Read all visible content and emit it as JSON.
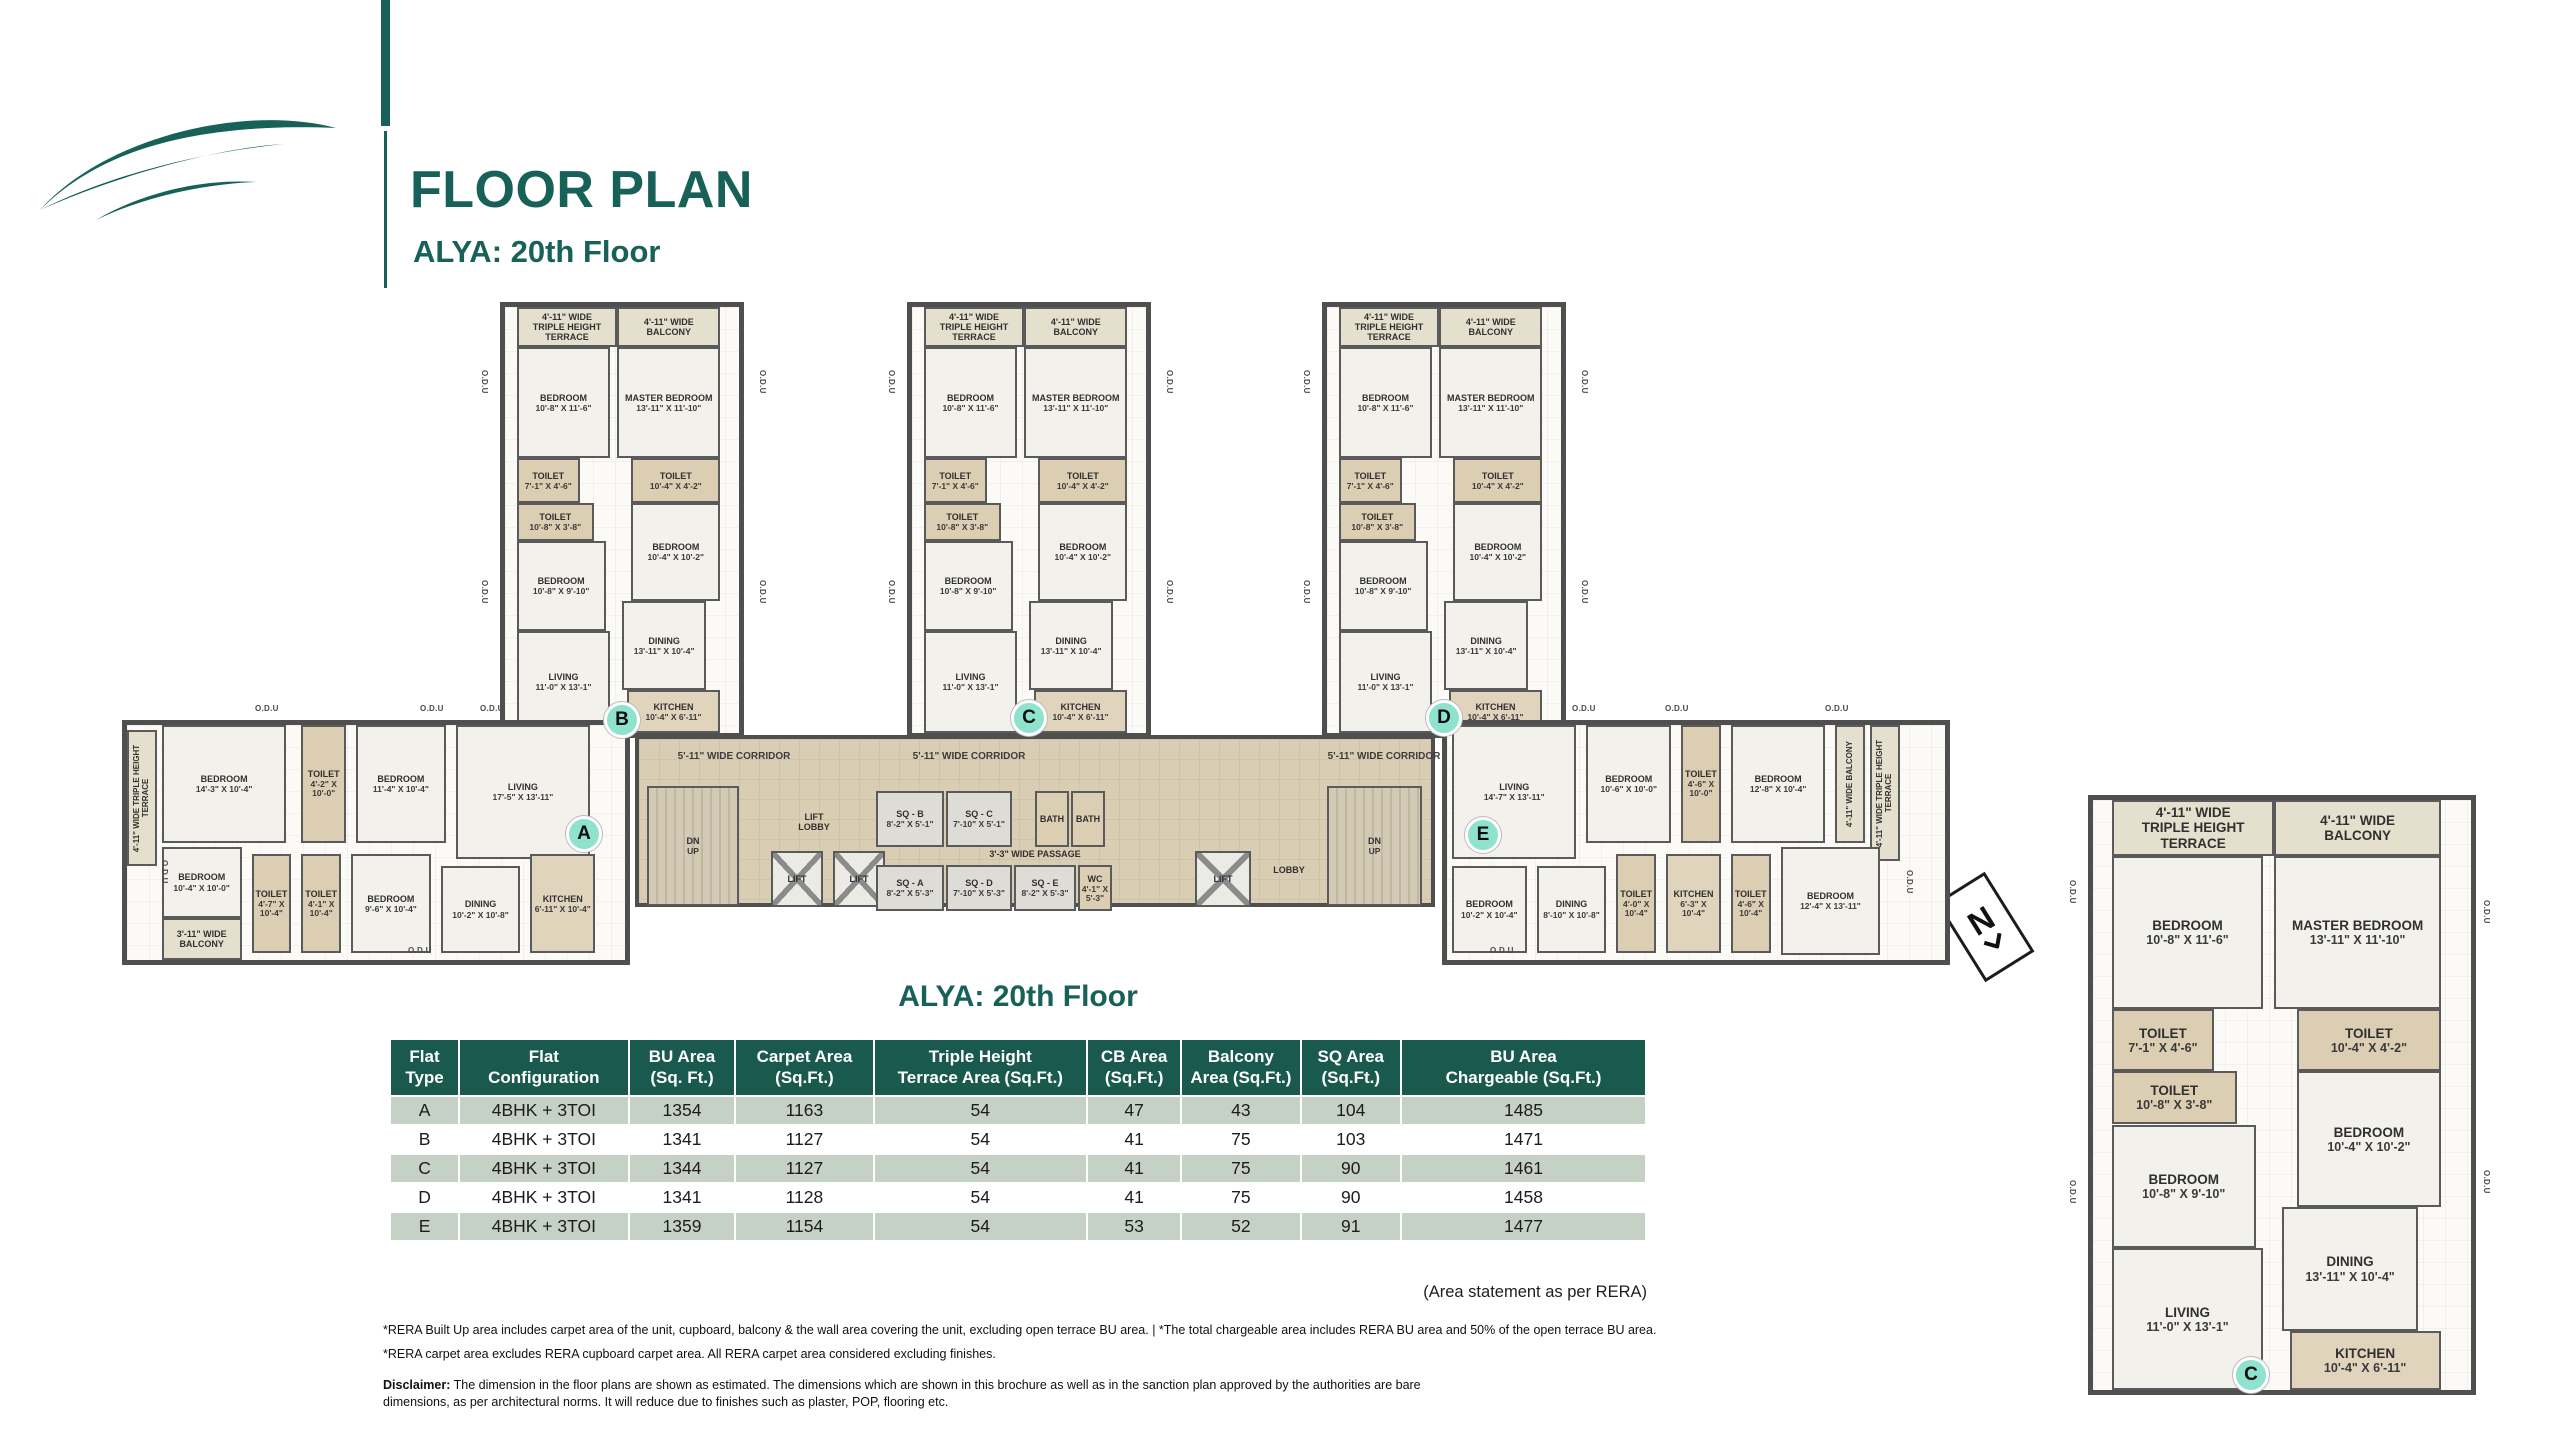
{
  "header": {
    "title": "FLOOR PLAN",
    "subtitle": "ALYA: 20th Floor"
  },
  "colors": {
    "brand_teal": "#176158",
    "table_header_green": "#1a5a4e",
    "row_sage": "#c6d1c6",
    "corridor_tan": "#d9cdb3",
    "wall_gray": "#4f4f4f",
    "marker_mint": "#8fe2cd"
  },
  "compass": {
    "letter": "N"
  },
  "plan": {
    "odu": {
      "label": "O.D.U",
      "positions": [
        {
          "x": 480,
          "y": 370,
          "v": true
        },
        {
          "x": 480,
          "y": 580,
          "v": true
        },
        {
          "x": 758,
          "y": 370,
          "v": true
        },
        {
          "x": 758,
          "y": 580,
          "v": true
        },
        {
          "x": 887,
          "y": 370,
          "v": true
        },
        {
          "x": 887,
          "y": 580,
          "v": true
        },
        {
          "x": 1165,
          "y": 370,
          "v": true
        },
        {
          "x": 1165,
          "y": 580,
          "v": true
        },
        {
          "x": 1302,
          "y": 370,
          "v": true
        },
        {
          "x": 1302,
          "y": 580,
          "v": true
        },
        {
          "x": 1580,
          "y": 370,
          "v": true
        },
        {
          "x": 1580,
          "y": 580,
          "v": true
        },
        {
          "x": 255,
          "y": 704
        },
        {
          "x": 420,
          "y": 704
        },
        {
          "x": 480,
          "y": 704
        },
        {
          "x": 408,
          "y": 946
        },
        {
          "x": 1572,
          "y": 704
        },
        {
          "x": 1665,
          "y": 704
        },
        {
          "x": 1825,
          "y": 704
        },
        {
          "x": 1490,
          "y": 946
        },
        {
          "x": 160,
          "y": 860,
          "v": true
        },
        {
          "x": 1905,
          "y": 870,
          "v": true
        },
        {
          "x": 2068,
          "y": 880,
          "v": true
        },
        {
          "x": 2068,
          "y": 1180,
          "v": true
        },
        {
          "x": 2482,
          "y": 900,
          "v": true
        },
        {
          "x": 2482,
          "y": 1170,
          "v": true
        }
      ]
    },
    "markers": [
      {
        "letter": "A",
        "cx": 584,
        "cy": 834
      },
      {
        "letter": "B",
        "cx": 622,
        "cy": 720
      },
      {
        "letter": "C",
        "cx": 1029,
        "cy": 718
      },
      {
        "letter": "D",
        "cx": 1444,
        "cy": 718
      },
      {
        "letter": "E",
        "cx": 1483,
        "cy": 835
      },
      {
        "letter": "C",
        "cx": 2251,
        "cy": 1375
      }
    ],
    "sections": [
      {
        "id": "tower-b",
        "x": 500,
        "y": 302,
        "w": 244,
        "h": 436,
        "rooms": "tower"
      },
      {
        "id": "tower-c",
        "x": 907,
        "y": 302,
        "w": 244,
        "h": 436,
        "rooms": "tower"
      },
      {
        "id": "tower-d",
        "x": 1322,
        "y": 302,
        "w": 244,
        "h": 436,
        "rooms": "tower"
      },
      {
        "id": "wing-a",
        "x": 122,
        "y": 720,
        "w": 508,
        "h": 245,
        "rooms": "wing_a"
      },
      {
        "id": "wing-e",
        "x": 1442,
        "y": 720,
        "w": 508,
        "h": 245,
        "rooms": "wing_e"
      },
      {
        "id": "detail-c",
        "x": 2088,
        "y": 795,
        "w": 388,
        "h": 600,
        "rooms": "tower",
        "detail": true
      }
    ],
    "room_templates": {
      "tower": [
        {
          "t": "terrace",
          "label": "4'-11\" WIDE\nTRIPLE HEIGHT\nTERRACE",
          "x": 5,
          "y": 0,
          "w": 43,
          "h": 9.5
        },
        {
          "t": "balcony",
          "label": "4'-11\" WIDE\nBALCONY",
          "x": 48,
          "y": 0,
          "w": 44,
          "h": 9.5
        },
        {
          "t": "room",
          "label": "BEDROOM",
          "dims": "10'-8\" X 11'-6\"",
          "x": 5,
          "y": 9.5,
          "w": 40,
          "h": 26
        },
        {
          "t": "room",
          "label": "MASTER BEDROOM",
          "dims": "13'-11\" X 11'-10\"",
          "x": 48,
          "y": 9.5,
          "w": 44,
          "h": 26
        },
        {
          "t": "toilet",
          "label": "TOILET",
          "dims": "7'-1\" X 4'-6\"",
          "x": 5,
          "y": 35.5,
          "w": 27,
          "h": 10.5
        },
        {
          "t": "toilet",
          "label": "TOILET",
          "dims": "10'-4\" X 4'-2\"",
          "x": 54,
          "y": 35.5,
          "w": 38,
          "h": 10.5
        },
        {
          "t": "toilet",
          "label": "TOILET",
          "dims": "10'-8\" X 3'-8\"",
          "x": 5,
          "y": 46,
          "w": 33,
          "h": 9
        },
        {
          "t": "room",
          "label": "BEDROOM",
          "dims": "10'-8\" X 9'-10\"",
          "x": 5,
          "y": 55,
          "w": 38,
          "h": 21
        },
        {
          "t": "room",
          "label": "BEDROOM",
          "dims": "10'-4\" X 10'-2\"",
          "x": 54,
          "y": 46,
          "w": 38,
          "h": 23
        },
        {
          "t": "room",
          "label": "LIVING",
          "dims": "11'-0\" X 13'-1\"",
          "x": 5,
          "y": 76,
          "w": 40,
          "h": 24
        },
        {
          "t": "room",
          "label": "DINING",
          "dims": "13'-11\" X 10'-4\"",
          "x": 50,
          "y": 69,
          "w": 36,
          "h": 21
        },
        {
          "t": "kitchen",
          "label": "KITCHEN",
          "dims": "10'-4\" X 6'-11\"",
          "x": 52,
          "y": 90,
          "w": 40,
          "h": 10
        }
      ],
      "wing_a": [
        {
          "t": "terrace",
          "v": true,
          "label": "4'-11\" WIDE TRIPLE HEIGHT TERRACE",
          "x": 0,
          "y": 2,
          "w": 6,
          "h": 58
        },
        {
          "t": "room",
          "label": "BEDROOM",
          "dims": "14'-3\" X 10'-4\"",
          "x": 7,
          "y": 0,
          "w": 25,
          "h": 50
        },
        {
          "t": "toilet",
          "label": "TOILET",
          "dims": "4'-2\" X 10'-0\"",
          "x": 35,
          "y": 0,
          "w": 9,
          "h": 50
        },
        {
          "t": "room",
          "label": "BEDROOM",
          "dims": "11'-4\" X 10'-4\"",
          "x": 46,
          "y": 0,
          "w": 18,
          "h": 50
        },
        {
          "t": "room",
          "label": "LIVING",
          "dims": "17'-5\" X 13'-11\"",
          "x": 66,
          "y": 0,
          "w": 27,
          "h": 57
        },
        {
          "t": "room",
          "label": "BEDROOM",
          "dims": "10'-4\" X 10'-0\"",
          "x": 7,
          "y": 52,
          "w": 16,
          "h": 30
        },
        {
          "t": "balcony",
          "label": "3'-11\" WIDE\nBALCONY",
          "x": 7,
          "y": 82,
          "w": 16,
          "h": 18
        },
        {
          "t": "toilet",
          "label": "TOILET",
          "dims": "4'-7\" X 10'-4\"",
          "x": 25,
          "y": 55,
          "w": 8,
          "h": 42
        },
        {
          "t": "toilet",
          "label": "TOILET",
          "dims": "4'-1\" X 10'-4\"",
          "x": 35,
          "y": 55,
          "w": 8,
          "h": 42
        },
        {
          "t": "room",
          "label": "BEDROOM",
          "dims": "9'-6\" X 10'-4\"",
          "x": 45,
          "y": 55,
          "w": 16,
          "h": 42
        },
        {
          "t": "room",
          "label": "DINING",
          "dims": "10'-2\" X 10'-8\"",
          "x": 63,
          "y": 60,
          "w": 16,
          "h": 37
        },
        {
          "t": "kitchen",
          "label": "KITCHEN",
          "dims": "6'-11\" X 10'-4\"",
          "x": 81,
          "y": 55,
          "w": 13,
          "h": 42
        }
      ],
      "wing_e": [
        {
          "t": "room",
          "label": "LIVING",
          "dims": "14'-7\" X 13'-11\"",
          "x": 1,
          "y": 0,
          "w": 25,
          "h": 57
        },
        {
          "t": "room",
          "label": "BEDROOM",
          "dims": "10'-6\" X 10'-0\"",
          "x": 28,
          "y": 0,
          "w": 17,
          "h": 50
        },
        {
          "t": "toilet",
          "label": "TOILET",
          "dims": "4'-6\" X 10'-0\"",
          "x": 47,
          "y": 0,
          "w": 8,
          "h": 50
        },
        {
          "t": "room",
          "label": "BEDROOM",
          "dims": "12'-8\" X 10'-4\"",
          "x": 57,
          "y": 0,
          "w": 19,
          "h": 50
        },
        {
          "t": "balcony",
          "v": true,
          "label": "4'-11\" WIDE BALCONY",
          "x": 78,
          "y": 0,
          "w": 6,
          "h": 50
        },
        {
          "t": "terrace",
          "v": true,
          "label": "4'-11\" WIDE TRIPLE HEIGHT TERRACE",
          "x": 85,
          "y": 0,
          "w": 6,
          "h": 58
        },
        {
          "t": "room",
          "label": "BEDROOM",
          "dims": "10'-2\" X 10'-4\"",
          "x": 1,
          "y": 60,
          "w": 15,
          "h": 37
        },
        {
          "t": "room",
          "label": "DINING",
          "dims": "8'-10\" X 10'-8\"",
          "x": 18,
          "y": 60,
          "w": 14,
          "h": 37
        },
        {
          "t": "toilet",
          "label": "TOILET",
          "dims": "4'-0\" X 10'-4\"",
          "x": 34,
          "y": 55,
          "w": 8,
          "h": 42
        },
        {
          "t": "kitchen",
          "label": "KITCHEN",
          "dims": "6'-3\" X 10'-4\"",
          "x": 44,
          "y": 55,
          "w": 11,
          "h": 42
        },
        {
          "t": "toilet",
          "label": "TOILET",
          "dims": "4'-6\" X 10'-4\"",
          "x": 57,
          "y": 55,
          "w": 8,
          "h": 42
        },
        {
          "t": "room",
          "label": "BEDROOM",
          "dims": "12'-4\" X 13'-11\"",
          "x": 67,
          "y": 52,
          "w": 20,
          "h": 46
        }
      ]
    },
    "corridor": {
      "x": 635,
      "y": 735,
      "w": 800,
      "h": 172,
      "wide_label": "5'-11\" WIDE CORRIDOR",
      "label_positions": [
        {
          "x": 95,
          "y": 12
        },
        {
          "x": 330,
          "y": 12
        },
        {
          "x": 745,
          "y": 12
        }
      ],
      "items": [
        {
          "t": "stair",
          "n": "staircase-left",
          "label": "DN",
          "dims": "UP",
          "x": 8,
          "y": 47,
          "w": 92,
          "h": 120
        },
        {
          "t": "plain",
          "n": "lift-lobby-label",
          "label": "LIFT\nLOBBY",
          "x": 128,
          "y": 62,
          "w": 94,
          "h": 42
        },
        {
          "t": "lift",
          "n": "lift-1",
          "label": "LIFT",
          "x": 132,
          "y": 112,
          "w": 52,
          "h": 56
        },
        {
          "t": "lift",
          "n": "lift-2",
          "label": "LIFT",
          "x": 194,
          "y": 112,
          "w": 52,
          "h": 56
        },
        {
          "t": "sq",
          "n": "sq-b",
          "label": "SQ - B",
          "dims": "8'-2\" X 5'-1\"",
          "x": 237,
          "y": 52,
          "w": 68,
          "h": 56
        },
        {
          "t": "sq",
          "n": "sq-c",
          "label": "SQ - C",
          "dims": "7'-10\" X 5'-1\"",
          "x": 307,
          "y": 52,
          "w": 66,
          "h": 56
        },
        {
          "t": "bath",
          "n": "bath-1",
          "label": "BATH",
          "x": 396,
          "y": 52,
          "w": 34,
          "h": 56
        },
        {
          "t": "bath",
          "n": "bath-2",
          "label": "BATH",
          "x": 432,
          "y": 52,
          "w": 34,
          "h": 56
        },
        {
          "t": "plain",
          "n": "passage-label",
          "label": "3'-3\" WIDE PASSAGE",
          "x": 316,
          "y": 106,
          "w": 160,
          "h": 18
        },
        {
          "t": "sq",
          "n": "sq-a",
          "label": "SQ - A",
          "dims": "8'-2\" X 5'-3\"",
          "x": 237,
          "y": 126,
          "w": 68,
          "h": 46
        },
        {
          "t": "sq",
          "n": "sq-d",
          "label": "SQ - D",
          "dims": "7'-10\" X 5'-3\"",
          "x": 307,
          "y": 126,
          "w": 66,
          "h": 46
        },
        {
          "t": "sq",
          "n": "sq-e",
          "label": "SQ - E",
          "dims": "8'-2\" X 5'-3\"",
          "x": 375,
          "y": 126,
          "w": 62,
          "h": 46
        },
        {
          "t": "wc",
          "n": "wc",
          "label": "WC",
          "dims": "4'-1\" X 5'-3\"",
          "x": 439,
          "y": 126,
          "w": 34,
          "h": 46
        },
        {
          "t": "lift",
          "n": "lift-3",
          "label": "LIFT",
          "x": 556,
          "y": 112,
          "w": 56,
          "h": 56
        },
        {
          "t": "plain",
          "n": "lobby-label",
          "label": "LOBBY",
          "x": 618,
          "y": 120,
          "w": 64,
          "h": 22
        },
        {
          "t": "stair",
          "n": "staircase-right",
          "label": "DN",
          "dims": "UP",
          "x": 688,
          "y": 47,
          "w": 95,
          "h": 120
        }
      ]
    }
  },
  "table": {
    "title": "ALYA: 20th Floor",
    "columns": [
      "Flat\nType",
      "Flat\nConfiguration",
      "BU Area\n(Sq. Ft.)",
      "Carpet Area\n(Sq.Ft.)",
      "Triple Height\nTerrace Area (Sq.Ft.)",
      "CB Area\n(Sq.Ft.)",
      "Balcony\nArea (Sq.Ft.)",
      "SQ Area\n(Sq.Ft.)",
      "BU Area\nChargeable (Sq.Ft.)"
    ],
    "rows": [
      [
        "A",
        "4BHK + 3TOI",
        "1354",
        "1163",
        "54",
        "47",
        "43",
        "104",
        "1485"
      ],
      [
        "B",
        "4BHK + 3TOI",
        "1341",
        "1127",
        "54",
        "41",
        "75",
        "103",
        "1471"
      ],
      [
        "C",
        "4BHK + 3TOI",
        "1344",
        "1127",
        "54",
        "41",
        "75",
        "90",
        "1461"
      ],
      [
        "D",
        "4BHK + 3TOI",
        "1341",
        "1128",
        "54",
        "41",
        "75",
        "90",
        "1458"
      ],
      [
        "E",
        "4BHK + 3TOI",
        "1359",
        "1154",
        "54",
        "53",
        "52",
        "91",
        "1477"
      ]
    ],
    "note": "(Area statement as per RERA)"
  },
  "footnotes": {
    "line1": "*RERA Built Up area includes carpet area of the unit, cupboard, balcony & the wall area covering the unit, excluding open terrace BU area. | *The total chargeable area includes RERA BU area and 50% of the open terrace BU area.",
    "line2": "*RERA carpet area excludes RERA cupboard carpet area. All RERA carpet area considered excluding finishes.",
    "disclaimer_label": "Disclaimer:",
    "disclaimer_text": "The dimension in the floor plans are shown as estimated. The dimensions which are shown in this brochure as well as in the sanction plan approved by the authorities are bare dimensions, as per architectural norms. It will reduce due to finishes such as plaster, POP, flooring etc."
  }
}
